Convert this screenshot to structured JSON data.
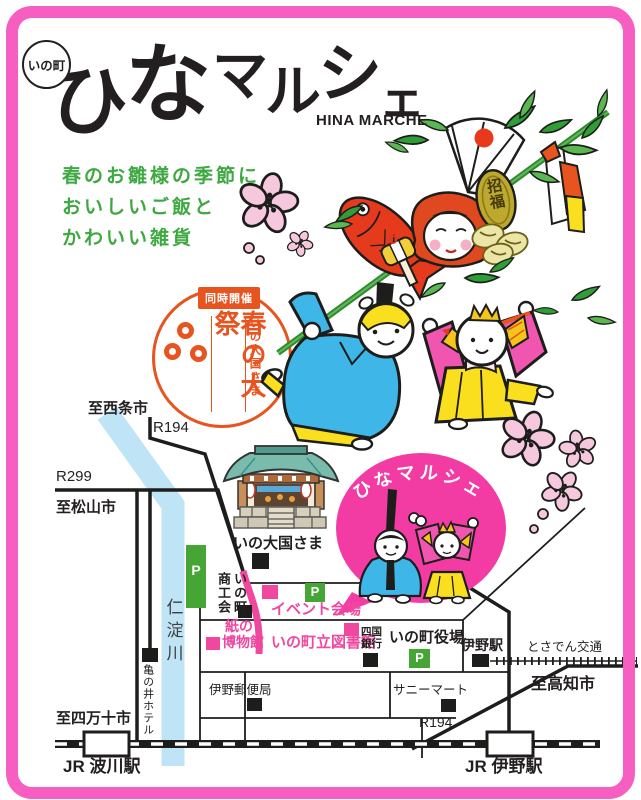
{
  "colors": {
    "accent_orange": "#e8541f",
    "accent_green": "#3ea841",
    "accent_pink": "#f0479f",
    "bubble_pink": "#f23ca4",
    "border_pink": "#f65ec2",
    "river_blue": "#bfe4f6",
    "parking_green": "#45a635",
    "doll_blue": "#3fb6e8",
    "doll_yellow": "#fadf1e",
    "doll_pink": "#f056b0"
  },
  "header": {
    "area_badge": "いの町",
    "title_chars": [
      "ひ",
      "な",
      "マ",
      "ル",
      "シ",
      "ェ"
    ],
    "subtitle": "HINA MARCHE"
  },
  "tagline": {
    "lines": [
      "春のお雛様の季節に",
      "おいしいご飯と",
      "かわいい雑貨"
    ]
  },
  "festival": {
    "badge": "同時開催",
    "title": "春の大祭",
    "organizer": "いの大国さま"
  },
  "bubble": {
    "label": "ひなマルシェ"
  },
  "illustration": {
    "plaque": "招福"
  },
  "map": {
    "parking_label": "P",
    "labels": {
      "to_saijo": "至西条市",
      "route194": "R194",
      "route299": "R299",
      "to_matsuyama": "至松山市",
      "river": "仁淀川",
      "shrine": "いの大国さま",
      "chamber_col_left": "商工会",
      "chamber_col_right": "いの町",
      "event_site": "イベント会場",
      "paper_museum_line1": "紙の",
      "paper_museum_line2": "博物館",
      "library": "いの町立図書館",
      "bank_line1": "四国",
      "bank_line2": "銀行",
      "town_hall": "いの町役場",
      "ino_station": "伊野駅",
      "tosaden": "とさでん交通",
      "to_kochi": "至高知市",
      "sunny_mart": "サニーマート",
      "post_office": "伊野郵便局",
      "hotel": "亀の井ホテル",
      "to_shimanto": "至四万十市",
      "jr_hakawa": "JR 波川駅",
      "jr_ino": "JR 伊野駅",
      "route194_south": "R194"
    }
  }
}
